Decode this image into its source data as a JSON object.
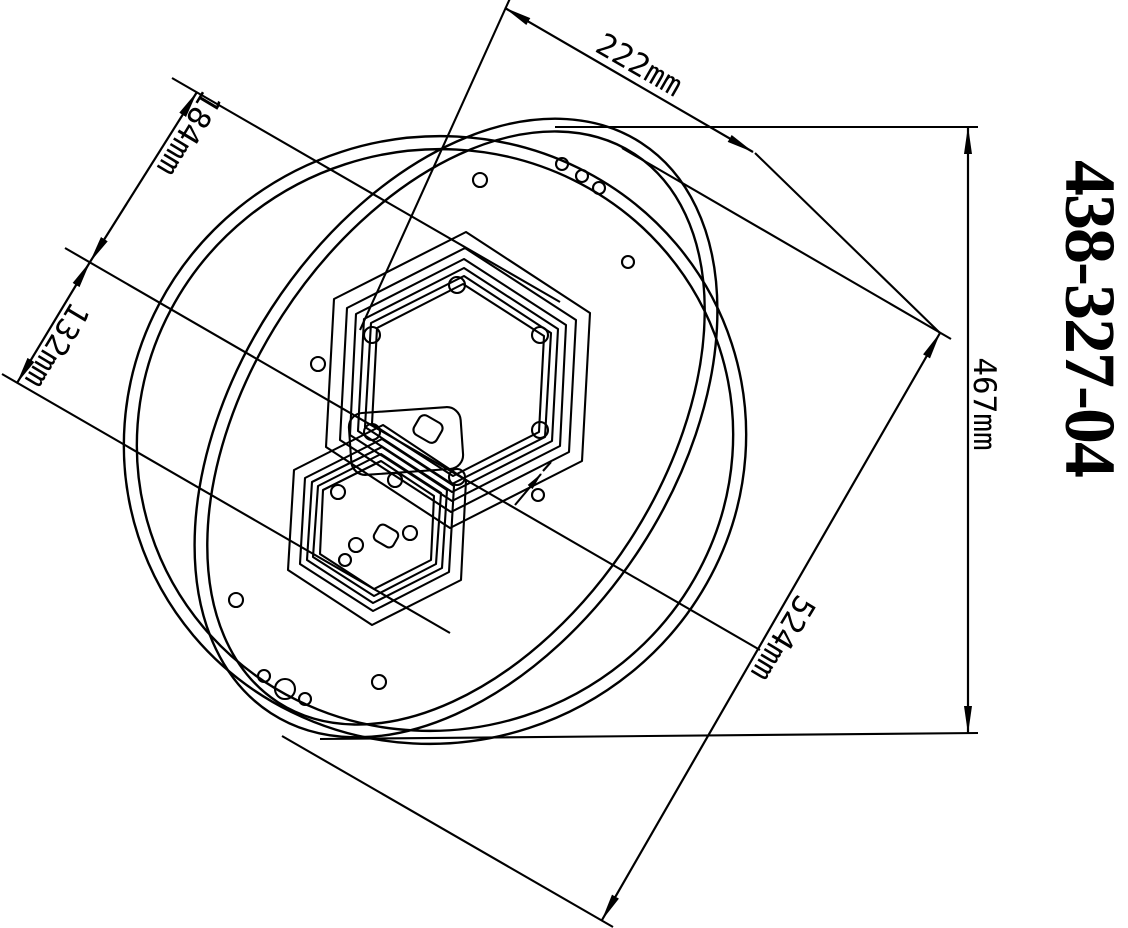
{
  "title": "438-327-04",
  "part_number": "438-327-04",
  "units": "mm",
  "dims": {
    "d222": {
      "label": "222mm",
      "value": 222
    },
    "d184": {
      "label": "184mm",
      "value": 184
    },
    "d132": {
      "label": "132mm",
      "value": 132
    },
    "d467": {
      "label": "467mm",
      "value": 467
    },
    "d524": {
      "label": "524mm",
      "value": 524
    }
  },
  "colors": {
    "line": "#000000",
    "background": "#ffffff"
  }
}
